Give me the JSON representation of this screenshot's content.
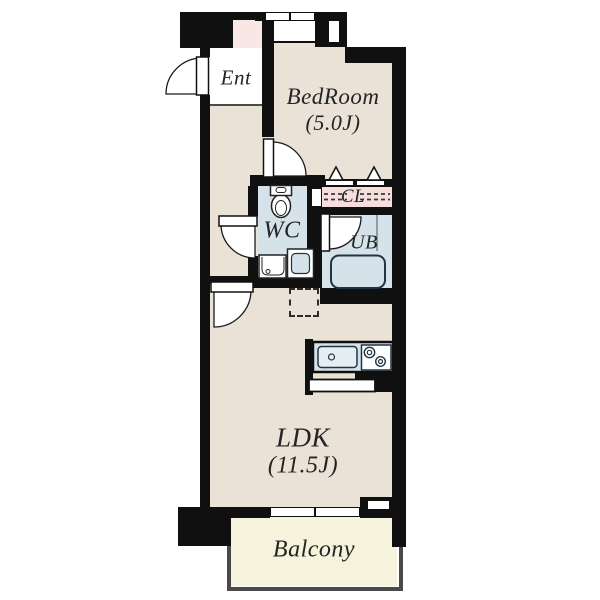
{
  "plan_type": "apartment floor plan (1LDK)",
  "rooms": {
    "ent": {
      "label": "Ent"
    },
    "bedroom": {
      "label": "BedRoom",
      "size": "(5.0J)"
    },
    "closet": {
      "label": "CL"
    },
    "wc": {
      "label": "WC"
    },
    "bath": {
      "label": "UB"
    },
    "ldk": {
      "label": "LDK",
      "size": "(11.5J)"
    },
    "balcony": {
      "label": "Balcony"
    }
  },
  "colors": {
    "wall": "#101010",
    "room_floor": "#ebe2d7",
    "wet_area_floor": "#d5e2ea",
    "closet_fill": "#f7dedd",
    "balcony_fill": "#f6f3dc",
    "accent_pink_block": "#f8e7e5",
    "outline": "#242424"
  }
}
